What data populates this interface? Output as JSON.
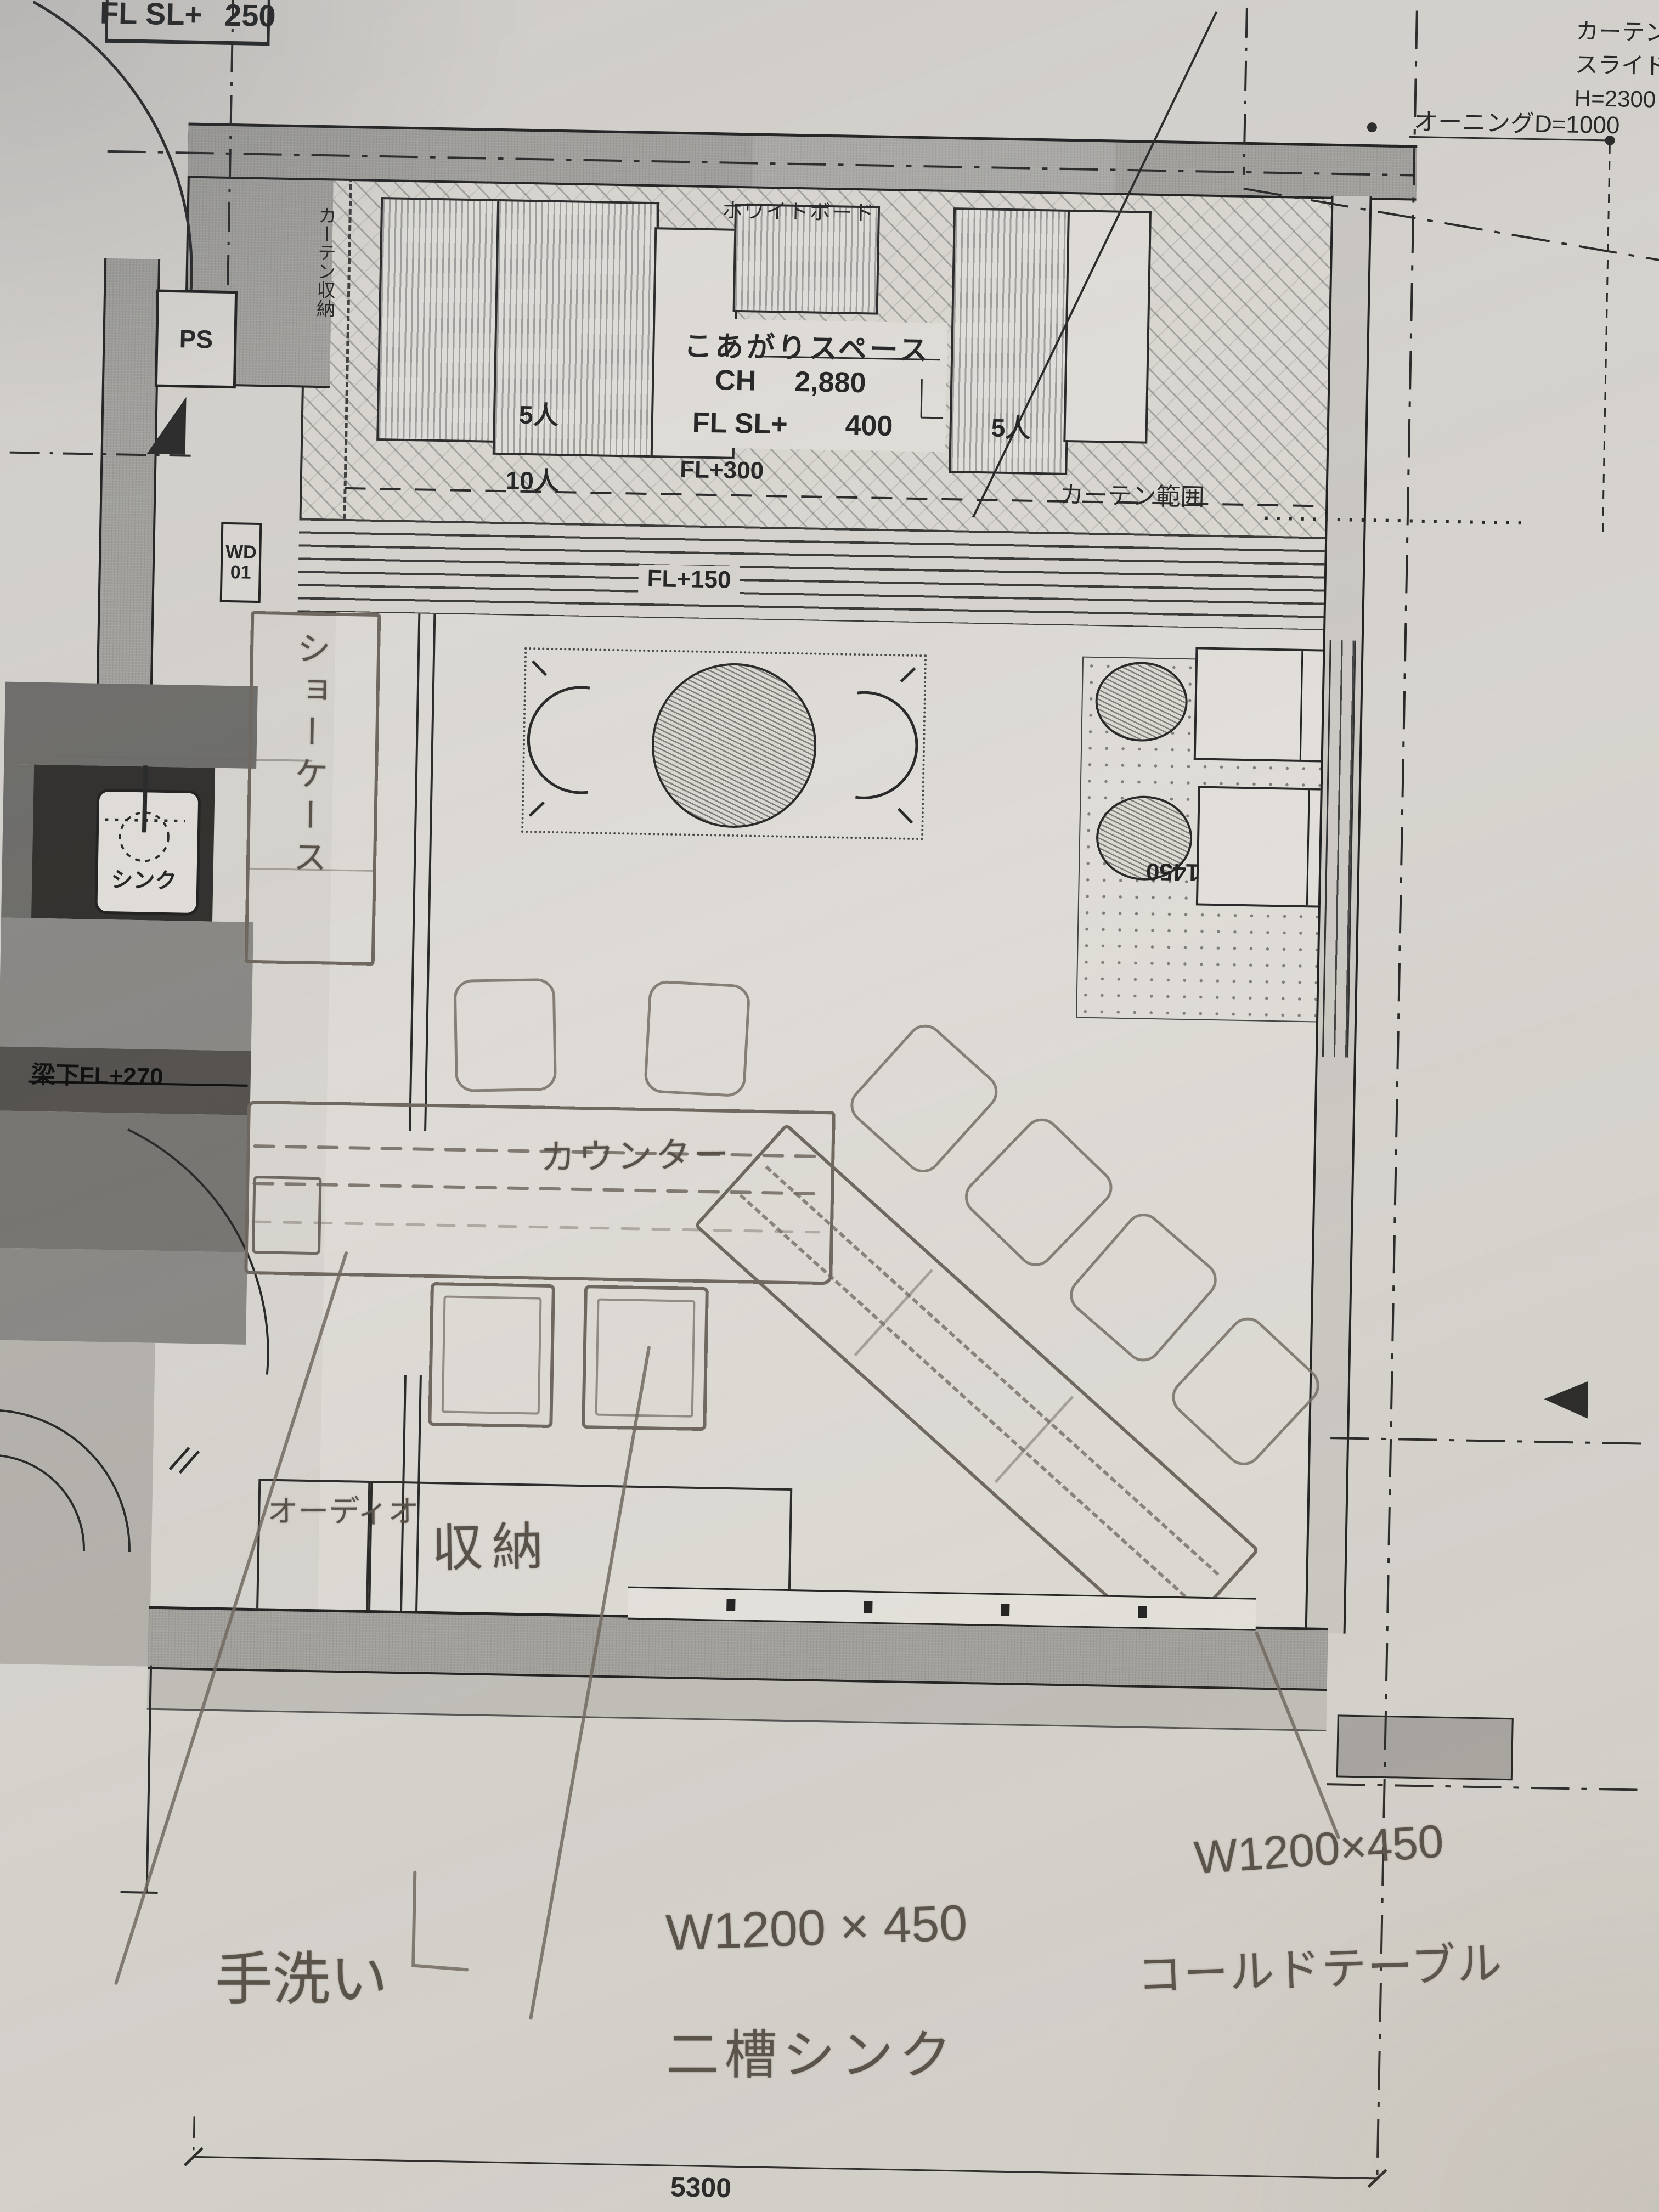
{
  "document": {
    "kind": "restaurant floor plan photo with pencil annotations"
  },
  "colors": {
    "paper": "#d9d6d1",
    "print_black": "#262626",
    "pencil_gray": "#6f6860",
    "wall_gray": "#a3a19d",
    "dark_counter": "#34322f"
  },
  "printed": {
    "flsl250_label": "FL SL+",
    "flsl250_value": "250",
    "note_line1": "カーテンレー",
    "note_line2": "スライドスト",
    "note_line3": "H=2300",
    "awning": "オーニングD=1000",
    "whiteboard": "ホワイトボード",
    "koagari": "こあがりスペース",
    "ch_label": "CH",
    "ch_value": "2,880",
    "flsl_label": "FL SL+",
    "flsl_value": "400",
    "seats5_left": "5人",
    "seats5_right": "5人",
    "seats10": "10人",
    "fl300": "FL+300",
    "curtain_range": "カーテン範囲",
    "curtain_storage": "カーテン収納",
    "wd": "WD",
    "wd_no": "01",
    "fl150": "FL+150",
    "ps": "PS",
    "sink": "シンク",
    "beam": "梁下FL+270",
    "dim_1450": "1450",
    "dim_5300": "5300"
  },
  "handwritten": {
    "showcase": "ショーケース",
    "counter": "カウンター",
    "audio": "オーディオ",
    "storage": "収納",
    "hand_wash": "手洗い",
    "sink_dim": "W1200 × 450",
    "sink_name": "二槽シンク",
    "cold_dim": "W1200×450",
    "cold_name": "コールドテーブル"
  }
}
